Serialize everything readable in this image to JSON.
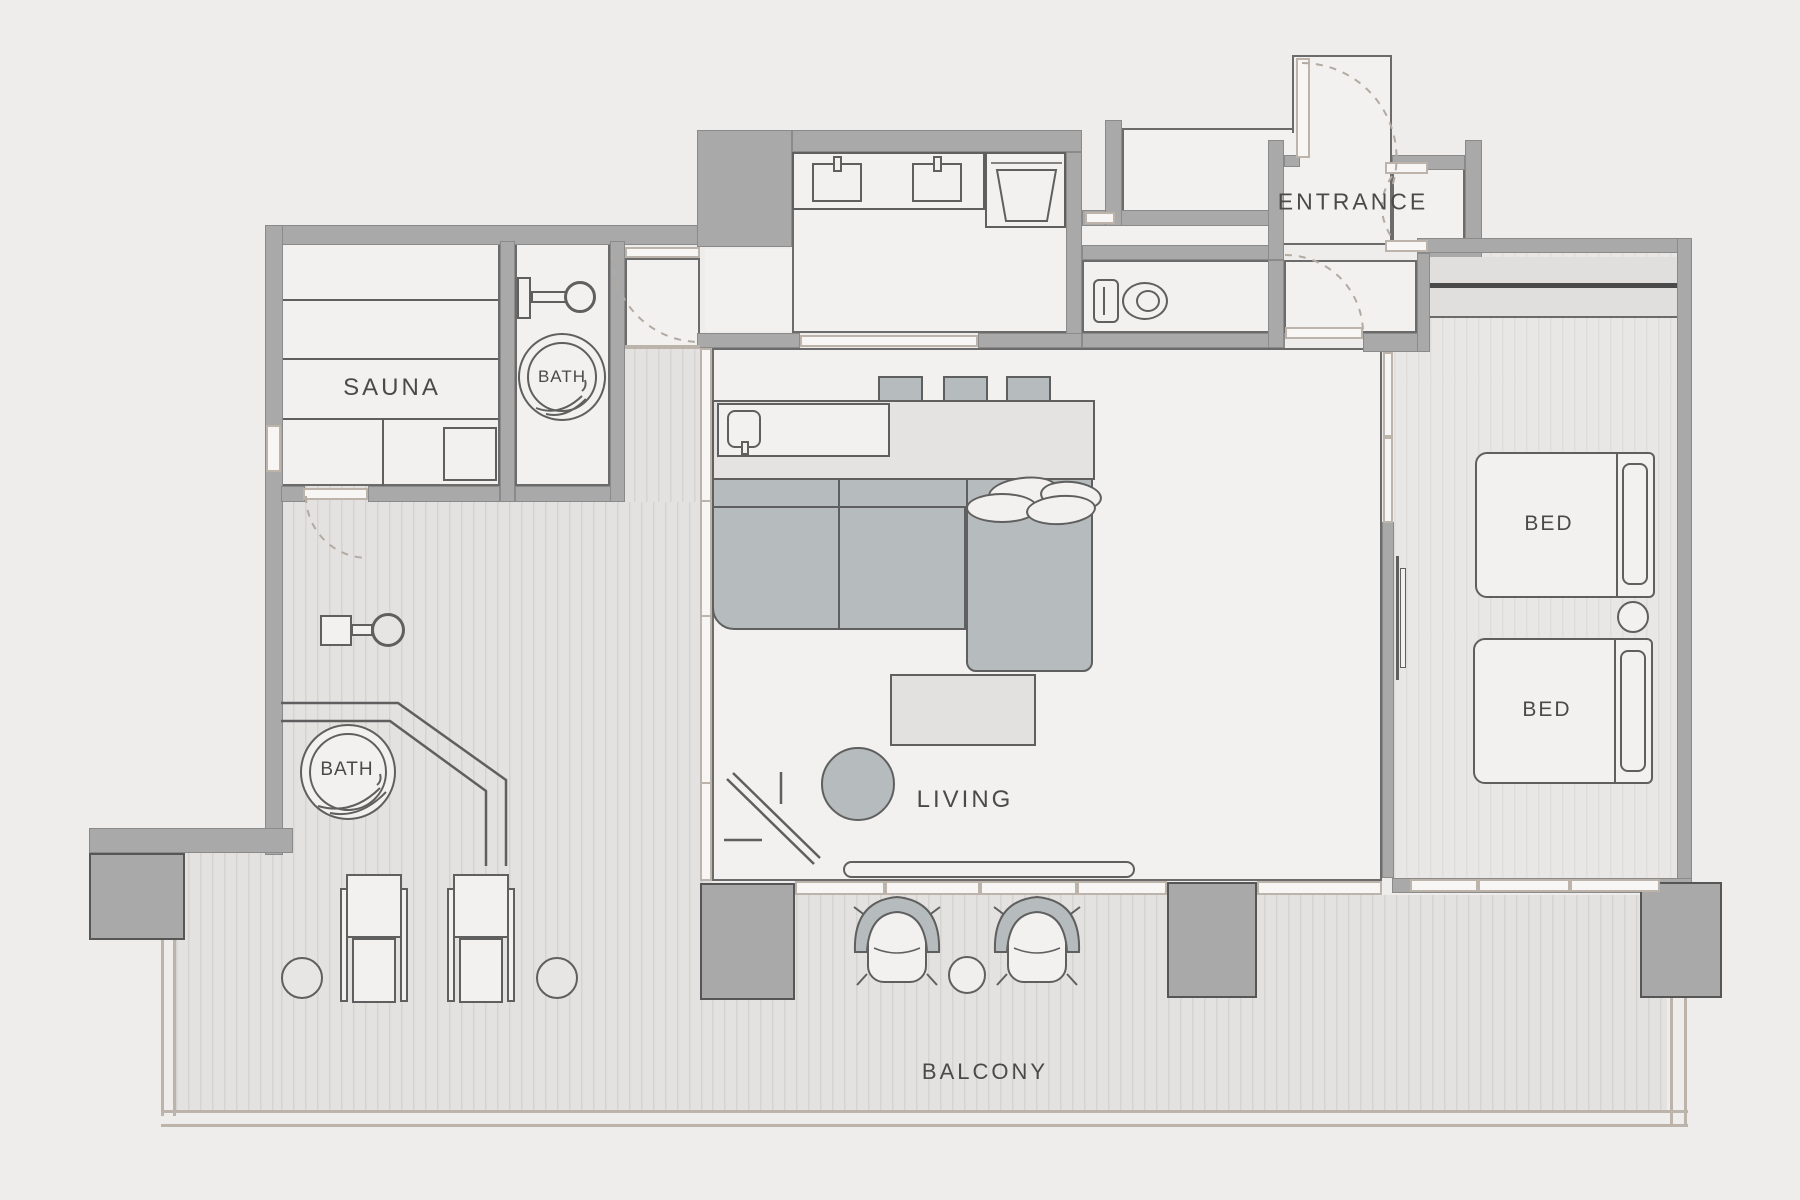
{
  "labels": {
    "sauna": "SAUNA",
    "bath": "BATH",
    "entrance": "ENTRANCE",
    "living": "LIVING",
    "bed": "BED",
    "balcony": "BALCONY"
  },
  "colors": {
    "background": "#eeedeb",
    "wall": "#a9a9a9",
    "wall_outline": "#6e6e6e",
    "floor": "#f2f1ef",
    "outdoor_floor": "#e3e2e0",
    "furniture_gray": "#b6bbbd",
    "line": "#5f5f5f",
    "door_swing": "#b3aaa2",
    "text": "#4a4a4a"
  }
}
